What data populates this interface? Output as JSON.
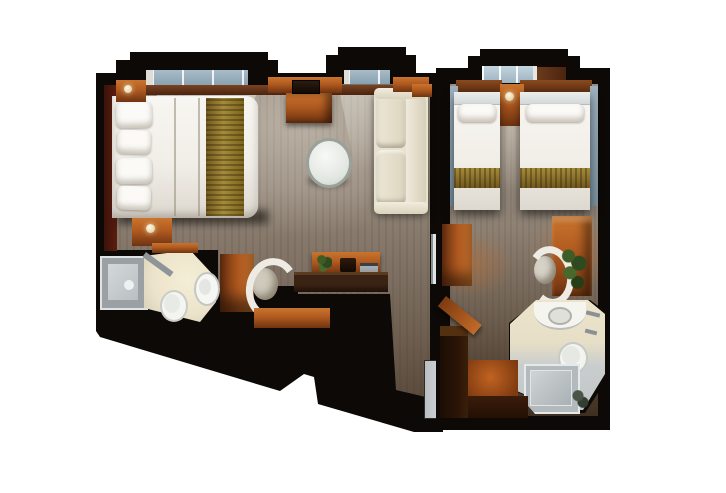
{
  "figure": {
    "kind": "floor-plan",
    "view": "top-down-3d-render",
    "visible_text": "",
    "rooms": [
      {
        "id": "left-cabin",
        "furniture": [
          "window-bay",
          "window-bay",
          "queen-bed",
          "pillows",
          "bed-runner",
          "headboard-wall",
          "nightstand",
          "nightstand",
          "dresser",
          "tv",
          "round-table",
          "sofa",
          "wall-shelf",
          "desk",
          "desk-shelf",
          "plant",
          "laptop",
          "cabinet",
          "desk-chair",
          "bench",
          "shower",
          "sink-counter",
          "basin",
          "toilet",
          "entry-door",
          "connecting-door"
        ]
      },
      {
        "id": "right-cabin",
        "furniture": [
          "window-bay",
          "twin-bed",
          "twin-bed",
          "center-nightstand",
          "overhead-cabinet",
          "overhead-cabinet",
          "curtain-panel",
          "curtain-panel",
          "wardrobe",
          "desk",
          "desk-chair",
          "plant",
          "sink-counter",
          "basin",
          "toilet",
          "shower",
          "corridor-closet",
          "floor-mat",
          "open-entry-door"
        ]
      }
    ]
  },
  "palette": {
    "bg": "#ffffff",
    "wall": "#0c0907",
    "carpet-light": "#9b9083",
    "carpet-base": "#93877a",
    "carpet-dark": "#3c2d20",
    "wood": "#b05a20",
    "wood-light": "#c9742e",
    "wood-dark": "#6f3310",
    "maroon": "#5c1d0e",
    "bed-white": "#f1eee8",
    "pillow": "#fbfaf7",
    "gold": "#a58a3a",
    "gold-dark": "#71581e",
    "sofa": "#e7e2cf",
    "glass": "#a8bcc8",
    "glass-bright": "#c2d4de",
    "bath-cream": "#ece4ca",
    "bath-gray": "#bfc5c7",
    "fixture-white": "#f4f2ec",
    "door-gray": "#c9ced1",
    "door-white": "#e0e4e6"
  }
}
